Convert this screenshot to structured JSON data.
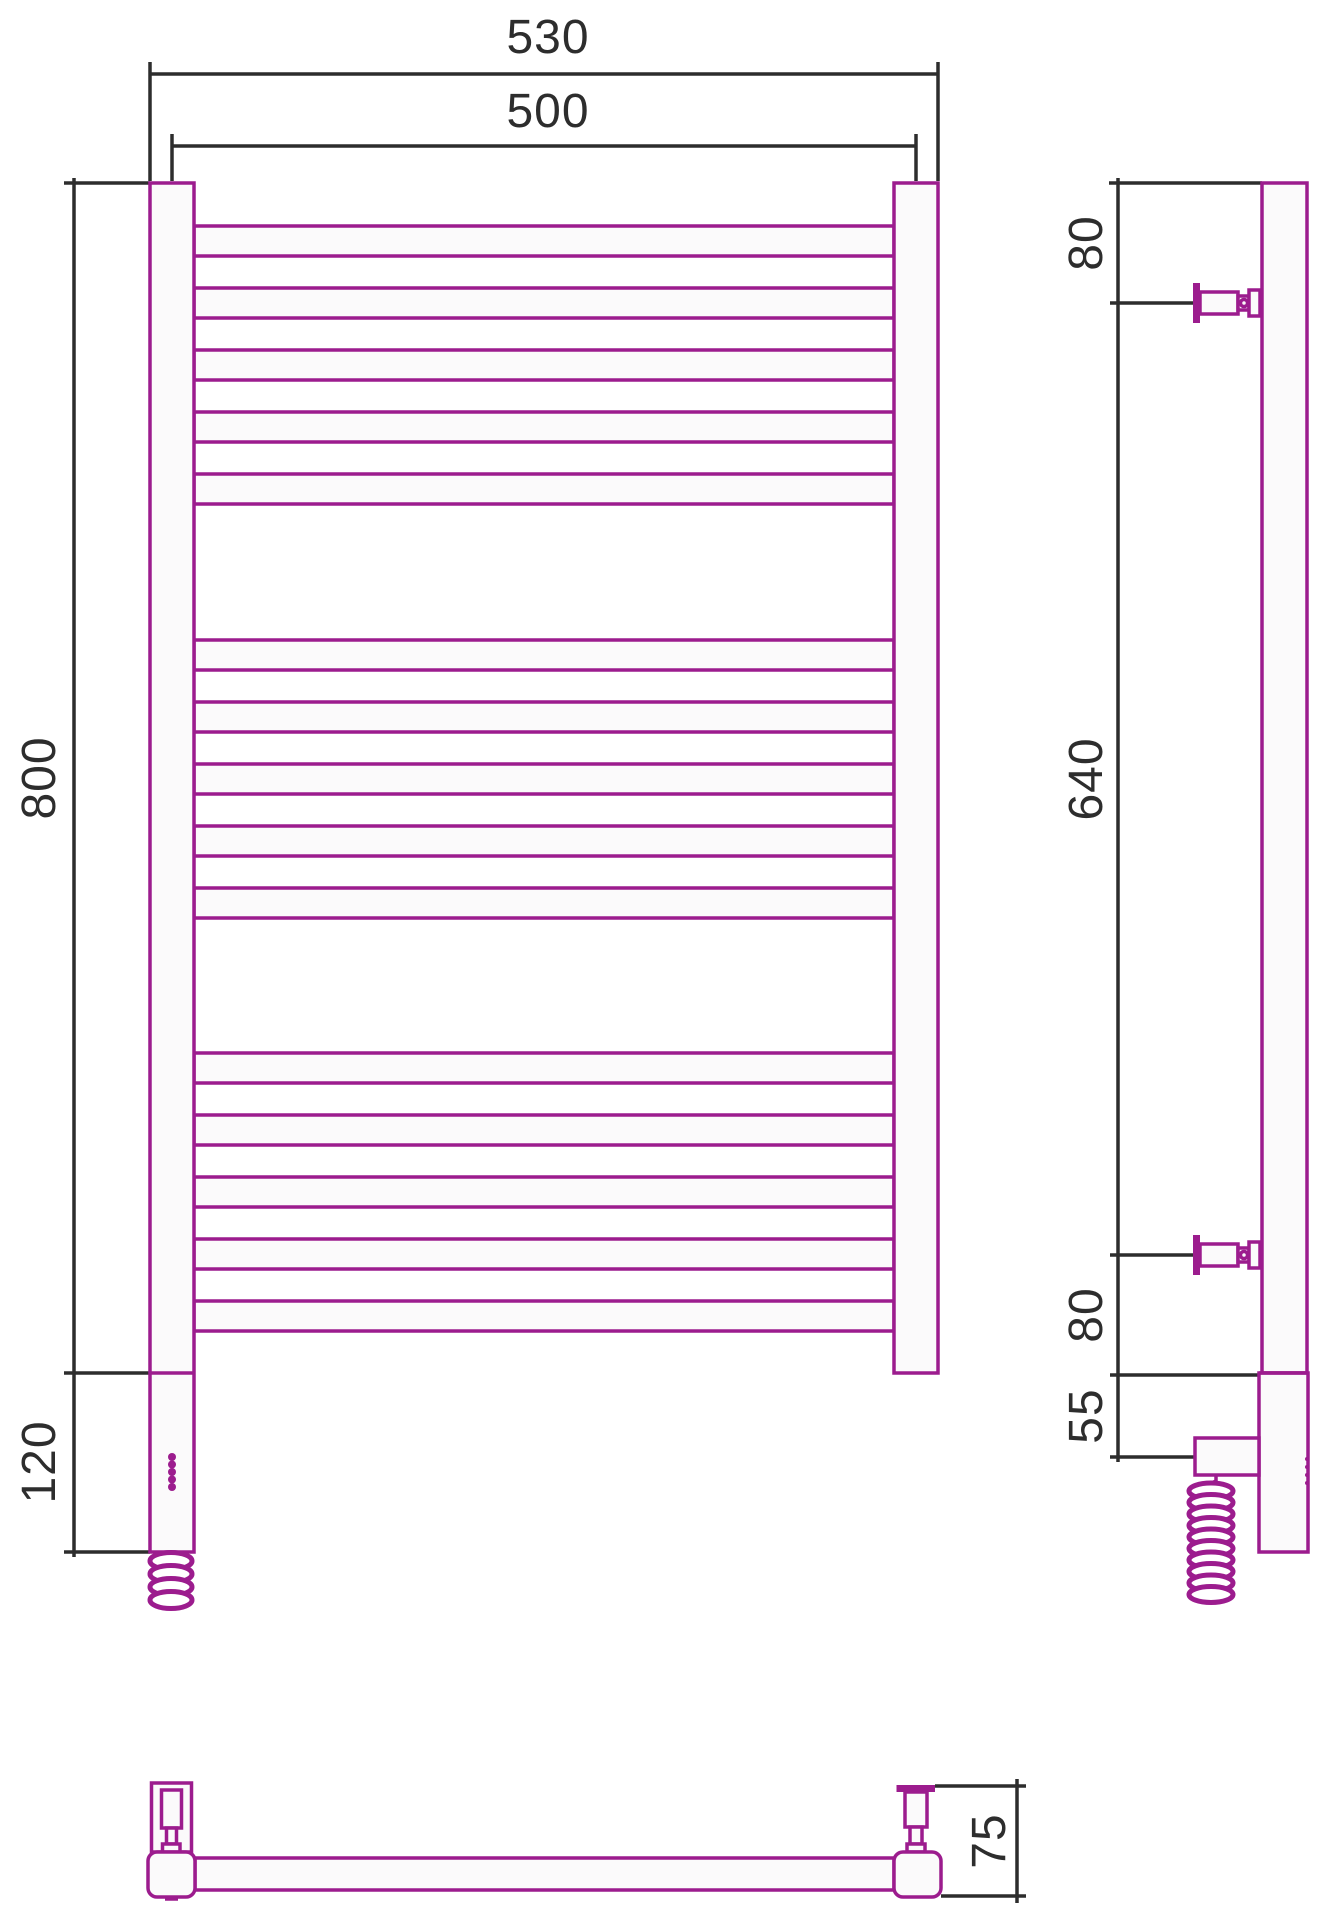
{
  "drawing": {
    "colors": {
      "outline": "#9c1c8e",
      "dimension_lines": "#2d2d2d",
      "tube_fill": "#fbfafb",
      "background": "#ffffff"
    },
    "front": {
      "rung_groups": 3,
      "rungs_per_group": 5,
      "rungs_total": 15,
      "led_dots": 5,
      "dims": {
        "overall_width": "530",
        "rail_width": "500",
        "body_height": "800",
        "heater_height": "120"
      }
    },
    "side": {
      "brackets": 2,
      "dims": {
        "top_offset": "80",
        "bracket_span": "640",
        "bottom_offset": "80",
        "heater_offset": "55"
      }
    },
    "plan": {
      "dims": {
        "depth": "75"
      }
    }
  }
}
